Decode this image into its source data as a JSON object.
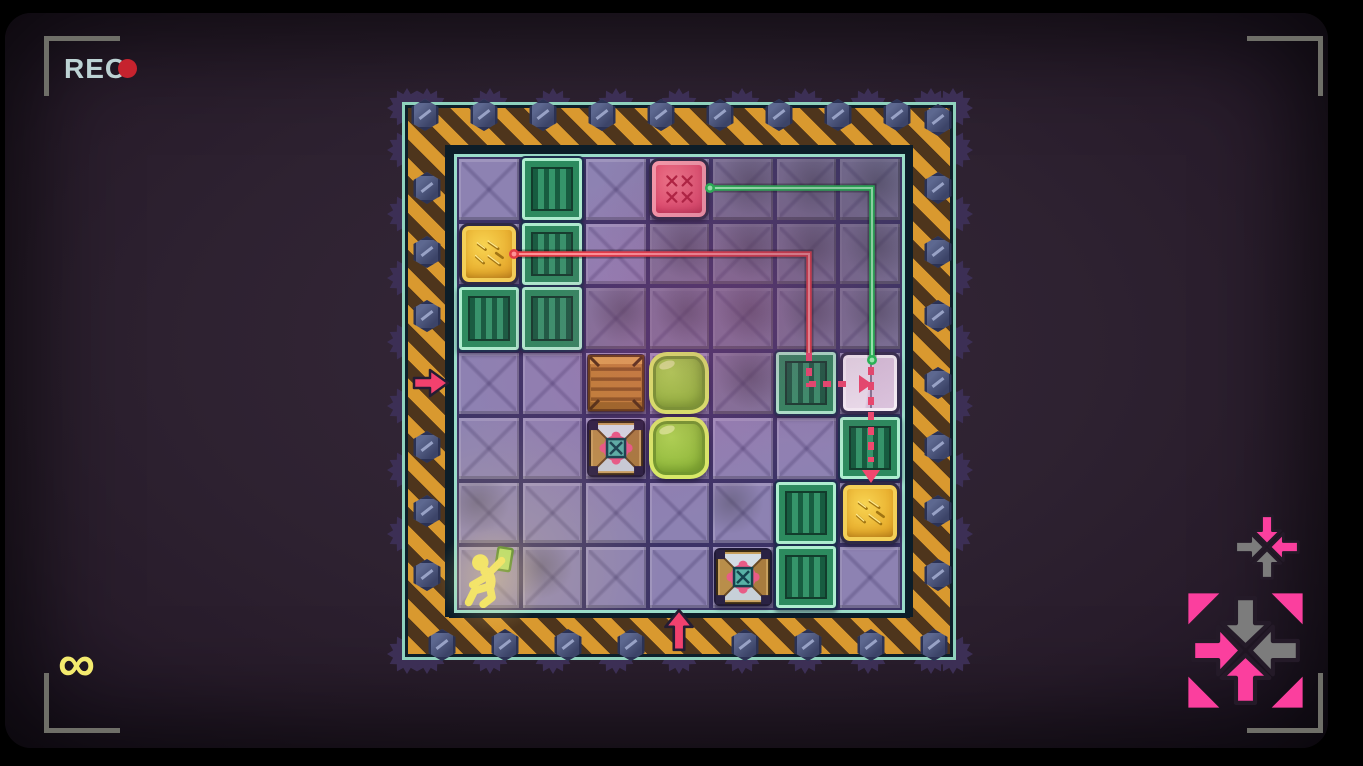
{
  "hud": {
    "rec_label": "REC",
    "rec_text_color": "#bdd3d4",
    "rec_dot_color": "#c6232e",
    "bracket_color": "#6f6f68",
    "moves_symbol": "∞",
    "moves_color": "#f3ea6e"
  },
  "icons": {
    "small_converge": {
      "arrows": {
        "top": {
          "dir": "down",
          "color": "#fb3f9e"
        },
        "left": {
          "dir": "right",
          "color": "#7c7c7c"
        },
        "right": {
          "dir": "left",
          "color": "#fb3f9e"
        },
        "bottom": {
          "dir": "up",
          "color": "#7c7c7c"
        }
      }
    },
    "large_converge": {
      "corner_color": "#fb3f9e",
      "arrows": {
        "top": {
          "dir": "down",
          "color": "#7c7c7c"
        },
        "left": {
          "dir": "right",
          "color": "#fb3f9e"
        },
        "right": {
          "dir": "left",
          "color": "#7c7c7c"
        },
        "bottom": {
          "dir": "up",
          "color": "#fb3f9e"
        }
      }
    }
  },
  "board": {
    "rows": 7,
    "cols": 7,
    "dark_cells": [
      [
        1,
        5
      ],
      [
        1,
        6
      ],
      [
        1,
        7
      ],
      [
        2,
        4
      ],
      [
        2,
        5
      ],
      [
        2,
        6
      ],
      [
        2,
        7
      ],
      [
        3,
        3
      ],
      [
        3,
        4
      ],
      [
        3,
        5
      ],
      [
        3,
        6
      ],
      [
        3,
        7
      ],
      [
        4,
        5
      ]
    ],
    "smudge_cells": [
      [
        6,
        1
      ],
      [
        6,
        5
      ],
      [
        7,
        2
      ]
    ],
    "entities": [
      {
        "row": 1,
        "col": 2,
        "type": "green-crate"
      },
      {
        "row": 1,
        "col": 4,
        "type": "pink-crate"
      },
      {
        "row": 2,
        "col": 1,
        "type": "gold-crate"
      },
      {
        "row": 2,
        "col": 2,
        "type": "green-crate"
      },
      {
        "row": 3,
        "col": 1,
        "type": "green-crate"
      },
      {
        "row": 3,
        "col": 2,
        "type": "green-crate"
      },
      {
        "row": 4,
        "col": 3,
        "type": "wood-crate"
      },
      {
        "row": 4,
        "col": 4,
        "type": "jelly"
      },
      {
        "row": 4,
        "col": 6,
        "type": "green-crate"
      },
      {
        "row": 4,
        "col": 7,
        "type": "white-crate"
      },
      {
        "row": 5,
        "col": 3,
        "type": "metal-crate"
      },
      {
        "row": 5,
        "col": 4,
        "type": "jelly"
      },
      {
        "row": 5,
        "col": 7,
        "type": "green-crate"
      },
      {
        "row": 6,
        "col": 6,
        "type": "green-crate"
      },
      {
        "row": 6,
        "col": 7,
        "type": "gold-crate"
      },
      {
        "row": 7,
        "col": 1,
        "type": "player"
      },
      {
        "row": 7,
        "col": 5,
        "type": "metal-crate"
      },
      {
        "row": 7,
        "col": 6,
        "type": "green-crate"
      }
    ],
    "entry_arrows": [
      {
        "side": "left",
        "row": 4,
        "dir": "right",
        "color": "#f2416e"
      },
      {
        "side": "bottom",
        "col": 4,
        "dir": "up",
        "color": "#f2416e"
      }
    ],
    "lasers": [
      {
        "name": "green-laser",
        "color": "#1ec352",
        "core": "#9effb8",
        "solid_path": [
          [
            253,
            31
          ],
          [
            415,
            31
          ],
          [
            415,
            201
          ]
        ],
        "dots": [
          [
            253,
            31
          ],
          [
            415,
            203
          ]
        ]
      },
      {
        "name": "red-laser",
        "color": "#e23c43",
        "core": "#ff9496",
        "dash_color": "#f0486e",
        "solid_path": [
          [
            57,
            97
          ],
          [
            352,
            97
          ],
          [
            352,
            196
          ]
        ],
        "dots": [
          [
            57,
            97
          ]
        ],
        "dashed_segments": [
          {
            "path": [
              [
                352,
                196
              ],
              [
                352,
                227
              ],
              [
                394,
                227
              ]
            ],
            "arrow_tip": [
              405,
              227
            ],
            "arrow_dir": "right"
          },
          {
            "path": [
              [
                414,
                210
              ],
              [
                414,
                305
              ]
            ],
            "arrow_tip": [
              414,
              316
            ],
            "arrow_dir": "down"
          }
        ]
      }
    ]
  }
}
